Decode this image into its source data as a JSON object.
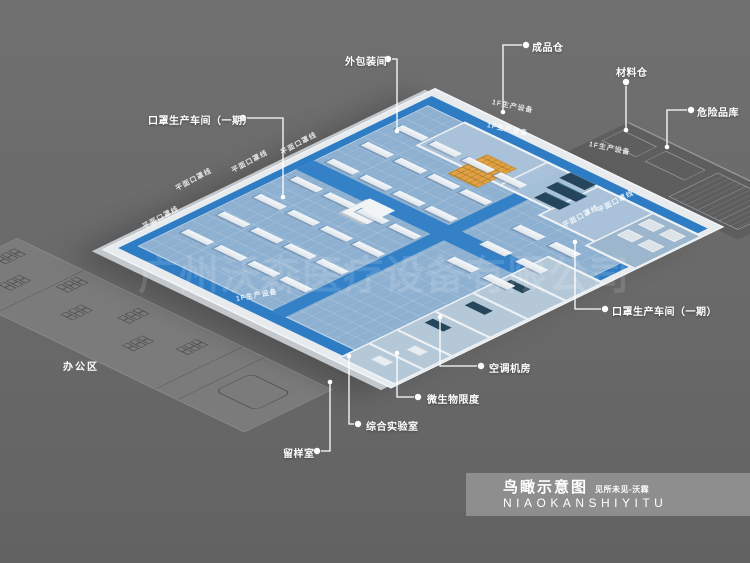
{
  "canvas": {
    "width": 750,
    "height": 563,
    "background": "#696969"
  },
  "watermark": {
    "text": "广州沃森医疗设备有限公司"
  },
  "office_label": {
    "text": "办公区"
  },
  "title_block": {
    "title": "鸟瞰示意图",
    "subtitle": "见所未见-沃霖",
    "pinyin": "NIAOKANSHIYITU"
  },
  "colors": {
    "floor_blue": "#8fb1d1",
    "aisle_blue": "#2e7cc4",
    "wall_white": "#eef2f5",
    "platform_gray": "#e7ebee",
    "pallet_orange": "#e0a145",
    "equipment_teal": "#25455c",
    "office_gray": "#7b7b7b",
    "label_white": "#ffffff"
  },
  "callouts": [
    {
      "id": "outer-packaging-room",
      "text": "外包装间",
      "tx": 345,
      "ty": 53,
      "dot": [
        388,
        59
      ],
      "line": [
        [
          392,
          59
        ],
        [
          397,
          59
        ],
        [
          397,
          131
        ]
      ],
      "end": [
        397,
        131
      ]
    },
    {
      "id": "finished-goods-warehouse",
      "text": "成品仓",
      "tx": 532,
      "ty": 39,
      "dot": [
        526,
        45
      ],
      "line": [
        [
          522,
          45
        ],
        [
          503,
          45
        ],
        [
          503,
          112
        ]
      ],
      "end": [
        503,
        112
      ]
    },
    {
      "id": "materials-warehouse",
      "text": "材料仓",
      "tx": 616,
      "ty": 64,
      "dot": [
        626,
        82
      ],
      "line": [
        [
          626,
          86
        ],
        [
          626,
          130
        ]
      ],
      "end": [
        626,
        130
      ]
    },
    {
      "id": "hazardous-goods-warehouse",
      "text": "危险品库",
      "tx": 697,
      "ty": 104,
      "dot": [
        691,
        110
      ],
      "line": [
        [
          687,
          110
        ],
        [
          667,
          110
        ],
        [
          667,
          147
        ]
      ],
      "end": [
        667,
        147
      ]
    },
    {
      "id": "mask-workshop-phase1-left",
      "text": "口罩生产车间（一期）",
      "tx": 148,
      "ty": 112,
      "dot": [
        243,
        118
      ],
      "line": [
        [
          247,
          118
        ],
        [
          283,
          118
        ],
        [
          283,
          197
        ]
      ],
      "end": [
        283,
        197
      ]
    },
    {
      "id": "mask-workshop-phase1-right",
      "text": "口罩生产车间（一期）",
      "tx": 612,
      "ty": 303,
      "dot": [
        605,
        309
      ],
      "line": [
        [
          601,
          309
        ],
        [
          575,
          309
        ],
        [
          575,
          242
        ]
      ],
      "end": [
        575,
        242
      ]
    },
    {
      "id": "hvac-room",
      "text": "空调机房",
      "tx": 489,
      "ty": 360,
      "dot": [
        481,
        366
      ],
      "line": [
        [
          477,
          366
        ],
        [
          440,
          366
        ],
        [
          440,
          317
        ]
      ],
      "end": [
        440,
        317
      ]
    },
    {
      "id": "microbial-limit-room",
      "text": "微生物限度",
      "tx": 427,
      "ty": 391,
      "dot": [
        418,
        397
      ],
      "line": [
        [
          414,
          397
        ],
        [
          397,
          397
        ],
        [
          397,
          353
        ]
      ],
      "end": [
        397,
        353
      ]
    },
    {
      "id": "comprehensive-lab",
      "text": "综合实验室",
      "tx": 366,
      "ty": 418,
      "dot": [
        358,
        424
      ],
      "line": [
        [
          354,
          424
        ],
        [
          349,
          424
        ],
        [
          349,
          356
        ]
      ],
      "end": [
        349,
        356
      ]
    },
    {
      "id": "sample-retention-room",
      "text": "留样室",
      "tx": 283,
      "ty": 445,
      "dot": [
        317,
        451
      ],
      "line": [
        [
          321,
          451
        ],
        [
          330,
          451
        ],
        [
          330,
          382
        ]
      ],
      "end": [
        330,
        382
      ]
    }
  ],
  "floor_texts": [
    {
      "text": "平面口罩线",
      "x": 143,
      "y": 222,
      "rot": -28
    },
    {
      "text": "平面口罩线",
      "x": 176,
      "y": 184,
      "rot": -28
    },
    {
      "text": "平面口罩线",
      "x": 232,
      "y": 166,
      "rot": -28
    },
    {
      "text": "平面口罩线",
      "x": 281,
      "y": 148,
      "rot": -28
    },
    {
      "text": "平面口罩线",
      "x": 563,
      "y": 221,
      "rot": -28
    },
    {
      "text": "平面口罩线",
      "x": 598,
      "y": 206,
      "rot": -28
    },
    {
      "text": "1F生产设备",
      "x": 492,
      "y": 97,
      "rot": 12
    },
    {
      "text": "1F生产设备",
      "x": 487,
      "y": 120,
      "rot": 12
    },
    {
      "text": "1F生产设备",
      "x": 589,
      "y": 139,
      "rot": 12
    },
    {
      "text": "1F生产设备",
      "x": 236,
      "y": 294,
      "rot": -10
    }
  ],
  "machines": {
    "left": {
      "cols": [
        36,
        96,
        156,
        214
      ],
      "rows": [
        64,
        106,
        148,
        192,
        236,
        280,
        324
      ],
      "w": 48,
      "h": 9
    },
    "right": {
      "cols": [
        330,
        395
      ],
      "rows": [
        118,
        158,
        198
      ],
      "w": 46,
      "h": 10
    }
  },
  "office_desks": {
    "clusters": [
      [
        16,
        14
      ],
      [
        70,
        44
      ],
      [
        126,
        12
      ],
      [
        182,
        44
      ],
      [
        240,
        14
      ],
      [
        296,
        46
      ],
      [
        352,
        18
      ]
    ],
    "rows": 3,
    "cols": 2,
    "table": [
      466,
      28,
      72,
      42
    ]
  }
}
